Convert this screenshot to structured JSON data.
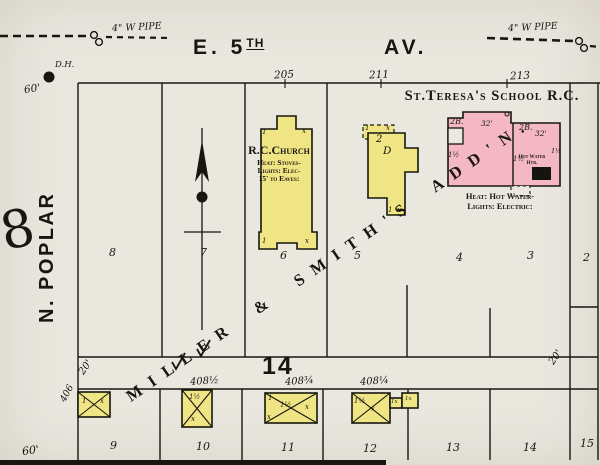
{
  "colors": {
    "paper": "#eae7df",
    "yellow": "#f0e584",
    "pink": "#f3b8c3",
    "ink": "#17160f",
    "heater": "#141411"
  },
  "streets": {
    "top_name": "E. 5",
    "top_name_sup": "TH",
    "top_name_suffix": "AV.",
    "west_name": "N. POPLAR"
  },
  "pipes": {
    "left": "4\" W PIPE",
    "right": "4\" W PIPE"
  },
  "hydrant": {
    "label": "D.H.",
    "distance": "60'"
  },
  "blocks": {
    "west": "8",
    "south": "14"
  },
  "subdivision": "MILLER & SMITH'S ADD'N.",
  "addresses": {
    "top": [
      "205",
      "211",
      "213"
    ],
    "west": "406",
    "south": [
      "408½",
      "408¾",
      "408¼"
    ]
  },
  "measurements": {
    "alley_left": "20'",
    "alley_right": "20'",
    "street_sw": "60'"
  },
  "lots": {
    "upper": [
      "8",
      "7",
      "6",
      "5",
      "4",
      "3",
      "2"
    ],
    "lower": [
      "9",
      "10",
      "11",
      "12",
      "13",
      "14",
      "15"
    ]
  },
  "church": {
    "name": "R.C.Church",
    "notes": [
      "Heat: Stoves-",
      "Lights: Elec-",
      "15' to Eaves:"
    ]
  },
  "school": {
    "title": "St.Teresa's School R.C.",
    "left_stories": "2B.",
    "left_width": "32'",
    "right_stories": "2B.",
    "right_width": "32'",
    "heater": "Hot Water Htr.",
    "notes": [
      "Heat: Hot Water-",
      "Lights: Electric:"
    ]
  },
  "marks": {
    "one": "1",
    "x": "x",
    "one_half": "1½",
    "one_x": "1x",
    "two": "2",
    "d": "D"
  }
}
